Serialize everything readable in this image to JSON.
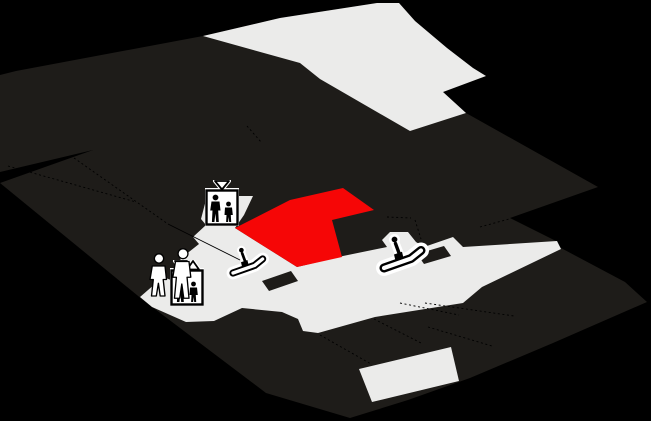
{
  "colors": {
    "background": "#000000",
    "floor": "#1e1c19",
    "walkway": "#ebebea",
    "highlight": "#f60606",
    "divider": "#000000",
    "icon_halo": "#ffffff",
    "icon_ink": "#000000"
  },
  "map": {
    "viewbox": "0 0 651 421",
    "shapes": [
      {
        "name": "floor-base",
        "fill": "floor",
        "interactable": false,
        "points": "16,71 203,36 280,18 377,3 399,3 415,21 447,48 473,68 486,76 443,92 466,113 598,187 510,218 556,241 561,248 625,282 647,302 553,343 470,378 408,400 350,418 266,393 143,300 0,183 93,150 0,172 0,75"
      },
      {
        "name": "walkway-upper",
        "fill": "walkway",
        "interactable": false,
        "points": "203,36 280,18 377,3 399,3 415,21 447,48 473,68 486,76 443,92 466,113 410,131 320,79 300,63"
      },
      {
        "name": "walkway-corridor",
        "fill": "walkway",
        "interactable": false,
        "points": "140,297 163,277 171,280 186,265 180,259 199,244 193,237 206,225 201,219 207,196 253,196 244,215 235,228 297,267 343,256 387,247 382,240 390,232 408,232 416,242 424,247 453,237 463,247 557,241 561,249 482,287 463,303 375,317 318,333 303,331 298,319 282,312 242,308 214,321 186,322 152,307"
      },
      {
        "name": "walkway-patch-lower",
        "fill": "walkway",
        "interactable": false,
        "points": "359,369 451,347 459,381 372,402"
      },
      {
        "name": "highlighted-store",
        "fill": "highlight",
        "interactable": true,
        "points": "343,188 374,210 332,220 342,257 297,267 235,228 290,200"
      },
      {
        "name": "kiosk-block-1",
        "fill": "floor",
        "interactable": false,
        "points": "262,281 291,271 298,281 269,291"
      },
      {
        "name": "kiosk-block-2",
        "fill": "floor",
        "interactable": false,
        "points": "417,254 444,246 451,256 424,264"
      }
    ],
    "divider_lines": [
      {
        "name": "store-divider",
        "dashed": true,
        "points": "8,166 136,202"
      },
      {
        "name": "store-divider",
        "dashed": true,
        "points": "74,158 168,224"
      },
      {
        "name": "store-divider",
        "dashed": false,
        "points": "168,224 240,260"
      },
      {
        "name": "store-divider",
        "dashed": true,
        "points": "247,126 261,142"
      },
      {
        "name": "store-divider",
        "dashed": true,
        "points": "387,217 411,218"
      },
      {
        "name": "store-divider",
        "dashed": true,
        "points": "415,220 421,239"
      },
      {
        "name": "store-divider",
        "dashed": true,
        "points": "480,227 509,219"
      },
      {
        "name": "store-divider",
        "dashed": true,
        "points": "425,303 514,316"
      },
      {
        "name": "store-divider",
        "dashed": true,
        "points": "428,327 492,346"
      },
      {
        "name": "store-divider",
        "dashed": true,
        "points": "320,335 371,364"
      },
      {
        "name": "store-divider",
        "dashed": true,
        "points": "374,319 421,343"
      },
      {
        "name": "store-divider",
        "dashed": true,
        "points": "400,303 459,315"
      }
    ],
    "icons": [
      {
        "type": "elevator-down",
        "name": "elevator-icon-upper",
        "x": 205,
        "y": 180,
        "scale": 1
      },
      {
        "type": "elevator-updown",
        "name": "elevator-icon-lower",
        "x": 170,
        "y": 260,
        "scale": 1
      },
      {
        "type": "escalator",
        "name": "escalator-icon-left",
        "x": 225,
        "y": 245,
        "scale": 0.8
      },
      {
        "type": "escalator",
        "name": "escalator-icon-right",
        "x": 374,
        "y": 233,
        "scale": 1
      },
      {
        "type": "pedestrians",
        "name": "pedestrians-icon",
        "x": 144,
        "y": 248,
        "scale": 1.5
      }
    ]
  }
}
